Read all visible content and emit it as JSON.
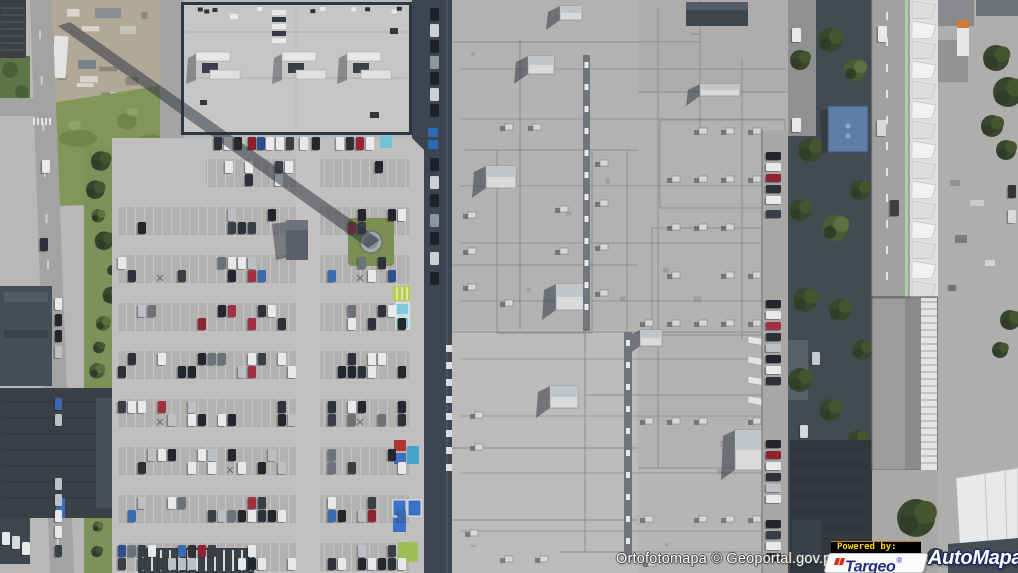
{
  "map": {
    "layer_label": "Ortofotomapa",
    "provider": "Geoportal.gov.pl",
    "attribution": "Ortofotomapa © Geoportal.gov.pl",
    "view": "aerial-orthophoto of shopping mall, parking lots and surrounding streets"
  },
  "branding": {
    "powered_by": "Powered by:",
    "powered_by_colors": {
      "bg": "#000000",
      "text": "#ffd400",
      "accent": "#c87f1f"
    },
    "targeo": {
      "name": "Targeo",
      "registered": "®",
      "brand_navy": "#232e7d",
      "brand_red": "#dd2b1c",
      "box_bg": "#fbfbfb"
    },
    "automapa": {
      "name": "AutoMapa",
      "registered": "®",
      "text_color": "#ffffff",
      "outline_color": "#1d2a66",
      "registered_color": "#3f63cf"
    }
  },
  "palette": {
    "concrete": "#b9b8b6",
    "mall_roof": "#b3b2b0",
    "store_roof": "#c7c6c4",
    "shadow_strip": "#3e4552",
    "grass": "#81975a",
    "tree_dark": "#39462e",
    "road": "#a3a4a2",
    "tent_white": "#eceded",
    "accent_blue_building": "#5f7da6"
  }
}
